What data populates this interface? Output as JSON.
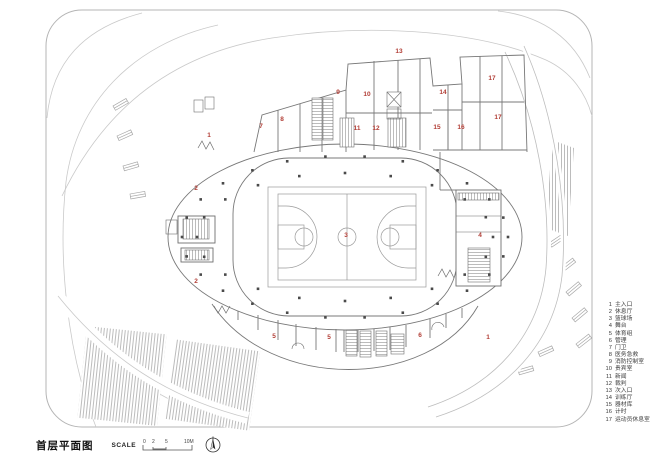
{
  "title": {
    "text": "首层平面图",
    "scale_label": "SCALE",
    "scale_ticks": [
      "0",
      "2",
      "5",
      "10M"
    ]
  },
  "north_arrow_icon": "north-arrow",
  "legend": {
    "items": [
      {
        "num": "1",
        "label": "主入口"
      },
      {
        "num": "2",
        "label": "休息厅"
      },
      {
        "num": "3",
        "label": "篮球场"
      },
      {
        "num": "4",
        "label": "舞台"
      },
      {
        "num": "5",
        "label": "体育组"
      },
      {
        "num": "6",
        "label": "管理"
      },
      {
        "num": "7",
        "label": "门卫"
      },
      {
        "num": "8",
        "label": "医务急救"
      },
      {
        "num": "9",
        "label": "消防控制室"
      },
      {
        "num": "10",
        "label": "贵宾室"
      },
      {
        "num": "11",
        "label": "新闻"
      },
      {
        "num": "12",
        "label": "裁判"
      },
      {
        "num": "13",
        "label": "次入口"
      },
      {
        "num": "14",
        "label": "训练厅"
      },
      {
        "num": "15",
        "label": "器材库"
      },
      {
        "num": "16",
        "label": "计时"
      },
      {
        "num": "17",
        "label": "运动员休息室"
      }
    ]
  },
  "plan_labels": [
    {
      "num": "1",
      "x": 209,
      "y": 136
    },
    {
      "num": "1",
      "x": 488,
      "y": 338
    },
    {
      "num": "2",
      "x": 196,
      "y": 189
    },
    {
      "num": "2",
      "x": 196,
      "y": 282
    },
    {
      "num": "3",
      "x": 346,
      "y": 236
    },
    {
      "num": "4",
      "x": 480,
      "y": 236
    },
    {
      "num": "5",
      "x": 274,
      "y": 337
    },
    {
      "num": "5",
      "x": 329,
      "y": 338
    },
    {
      "num": "6",
      "x": 420,
      "y": 336
    },
    {
      "num": "7",
      "x": 261,
      "y": 127
    },
    {
      "num": "8",
      "x": 282,
      "y": 120
    },
    {
      "num": "9",
      "x": 338,
      "y": 93
    },
    {
      "num": "10",
      "x": 367,
      "y": 95
    },
    {
      "num": "11",
      "x": 357,
      "y": 129
    },
    {
      "num": "12",
      "x": 376,
      "y": 129
    },
    {
      "num": "13",
      "x": 399,
      "y": 52
    },
    {
      "num": "14",
      "x": 443,
      "y": 93
    },
    {
      "num": "15",
      "x": 437,
      "y": 128
    },
    {
      "num": "16",
      "x": 461,
      "y": 128
    },
    {
      "num": "17",
      "x": 492,
      "y": 79
    },
    {
      "num": "17",
      "x": 498,
      "y": 118
    }
  ],
  "colors": {
    "label_red": "#b23e36",
    "wall": "#787878",
    "line": "#9a9a9a",
    "swirl": "#c9c9c9",
    "frame": "#b5b5b5",
    "hatch": "#bfbfbf",
    "column": "#4a4a4a",
    "legend_text": "#3c3c3c"
  }
}
